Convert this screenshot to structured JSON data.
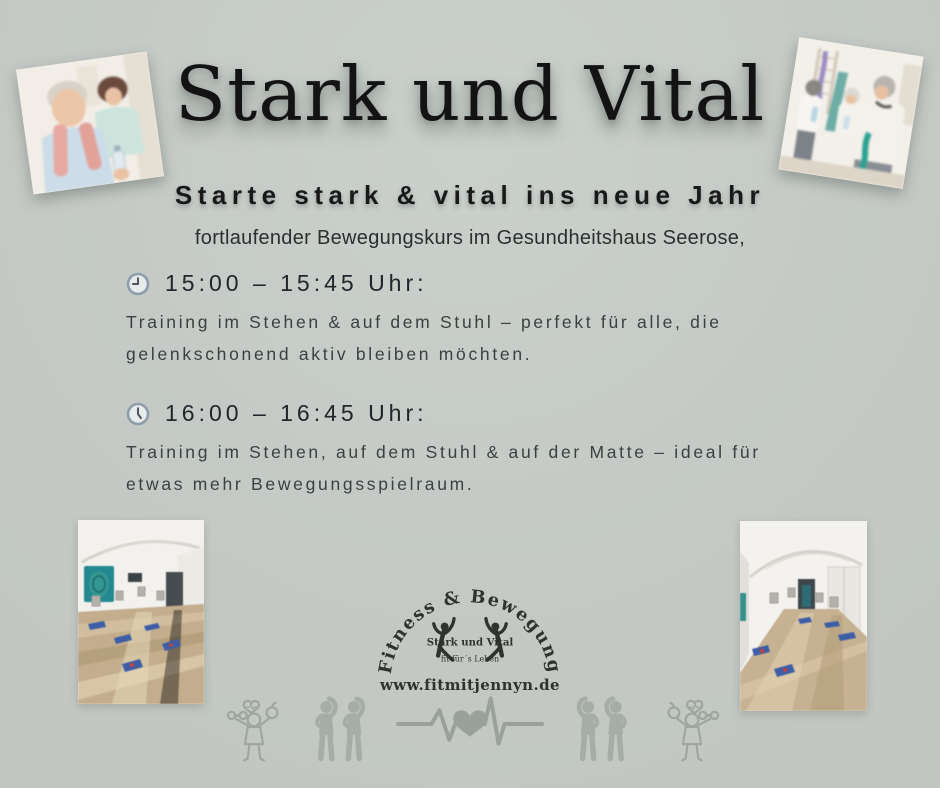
{
  "page": {
    "title": "Stark und Vital",
    "subtitle": "Starte stark & vital ins neue Jahr",
    "intro": "fortlaufender Bewegungskurs im Gesundheitshaus Seerose,"
  },
  "sessions": [
    {
      "time": "15:00  –  15:45 Uhr:",
      "line1": "Training im Stehen & auf dem Stuhl – perfekt für alle, die",
      "line2": "gelenkschonend aktiv bleiben möchten."
    },
    {
      "time": "16:00  –  16:45 Uhr:",
      "line1": "Training im Stehen, auf dem Stuhl & auf der Matte – ideal für",
      "line2": "etwas mehr Bewegungsspielraum."
    }
  ],
  "logo": {
    "arc_text": "Fitness & Bewegung",
    "brand": "Stark und Vital",
    "tagline": "fit für´s Leben",
    "website": "www.fitmitjennyn.de"
  },
  "icons": {
    "clock": "clock-icon",
    "fitness_figure": "fitness-figure-dumbbell-heart-apple-icon",
    "stretching_pair": "stretching-people-icon",
    "heartbeat": "heartbeat-heart-icon"
  },
  "photos": {
    "top_left": "seniors-with-towel-photo",
    "top_right": "seniors-resistance-band-photo",
    "bottom_left": "exercise-room-photo-left",
    "bottom_right": "exercise-room-photo-right"
  },
  "colors": {
    "background": "#c4c9c5",
    "title_text": "#131313",
    "body_text": "#394240",
    "clock_ring": "#8e9dab",
    "clock_face": "#e8ebec",
    "icon_gray": "#a3aaa4",
    "logo_ink": "#2e332f"
  }
}
